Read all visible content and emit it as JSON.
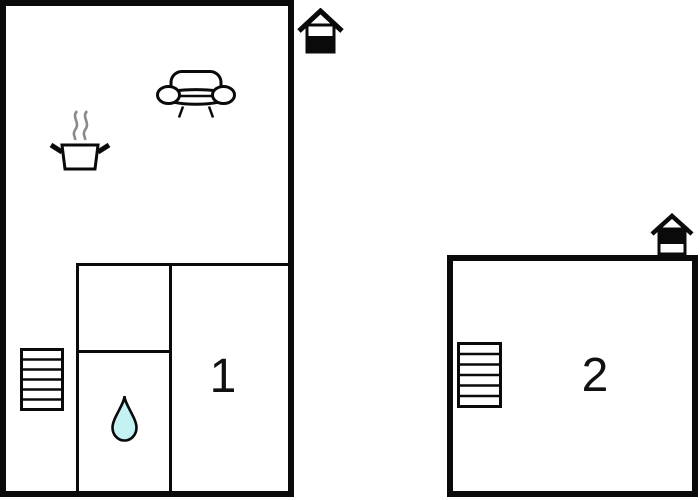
{
  "figure": {
    "type": "floor-plan",
    "description": "Two-unit holiday home floor plan schematic",
    "background_color": "#ffffff"
  },
  "colors": {
    "wall": "#0a0a0a",
    "interior_wall": "#0a0a0a",
    "water_drop_fill": "#c4f1f1",
    "steam": "#8a8a8a",
    "label_text": "#111111"
  },
  "plans": [
    {
      "unit_label": "1",
      "floor_icon": "house-ground-floor-icon",
      "icons": [
        "sofa-icon",
        "cooking-pot-icon",
        "stairs-icon",
        "water-drop-icon"
      ]
    },
    {
      "unit_label": "2",
      "floor_icon": "house-upper-floor-icon",
      "icons": [
        "stairs-icon"
      ]
    }
  ]
}
